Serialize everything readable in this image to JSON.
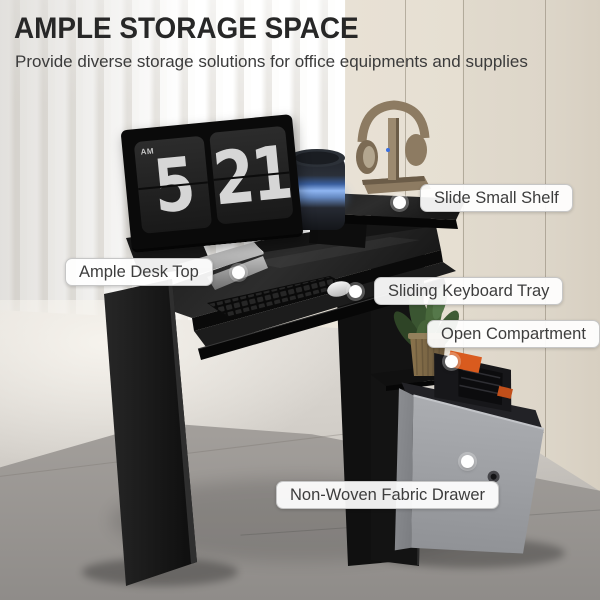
{
  "header": {
    "title": "AMPLE STORAGE SPACE",
    "subtitle": "Provide diverse storage solutions for office equipments and supplies"
  },
  "callouts": [
    {
      "label": "Slide Small Shelf"
    },
    {
      "label": "Ample Desk Top"
    },
    {
      "label": "Sliding Keyboard Tray"
    },
    {
      "label": "Open Compartment"
    },
    {
      "label": "Non-Woven Fabric Drawer"
    }
  ],
  "monitor_clock": {
    "period": "AM",
    "hour": "5",
    "minute": "21"
  },
  "colors": {
    "wall_beige": "#e9e2d6",
    "desk_black": "#141414",
    "drawer_gray": "#9fa1a5",
    "speaker_glow_blue": "#8fb6f2",
    "tool_accent_orange": "#d95b1e",
    "plant_green": "#49693c",
    "label_text": "#3d3d3d"
  }
}
